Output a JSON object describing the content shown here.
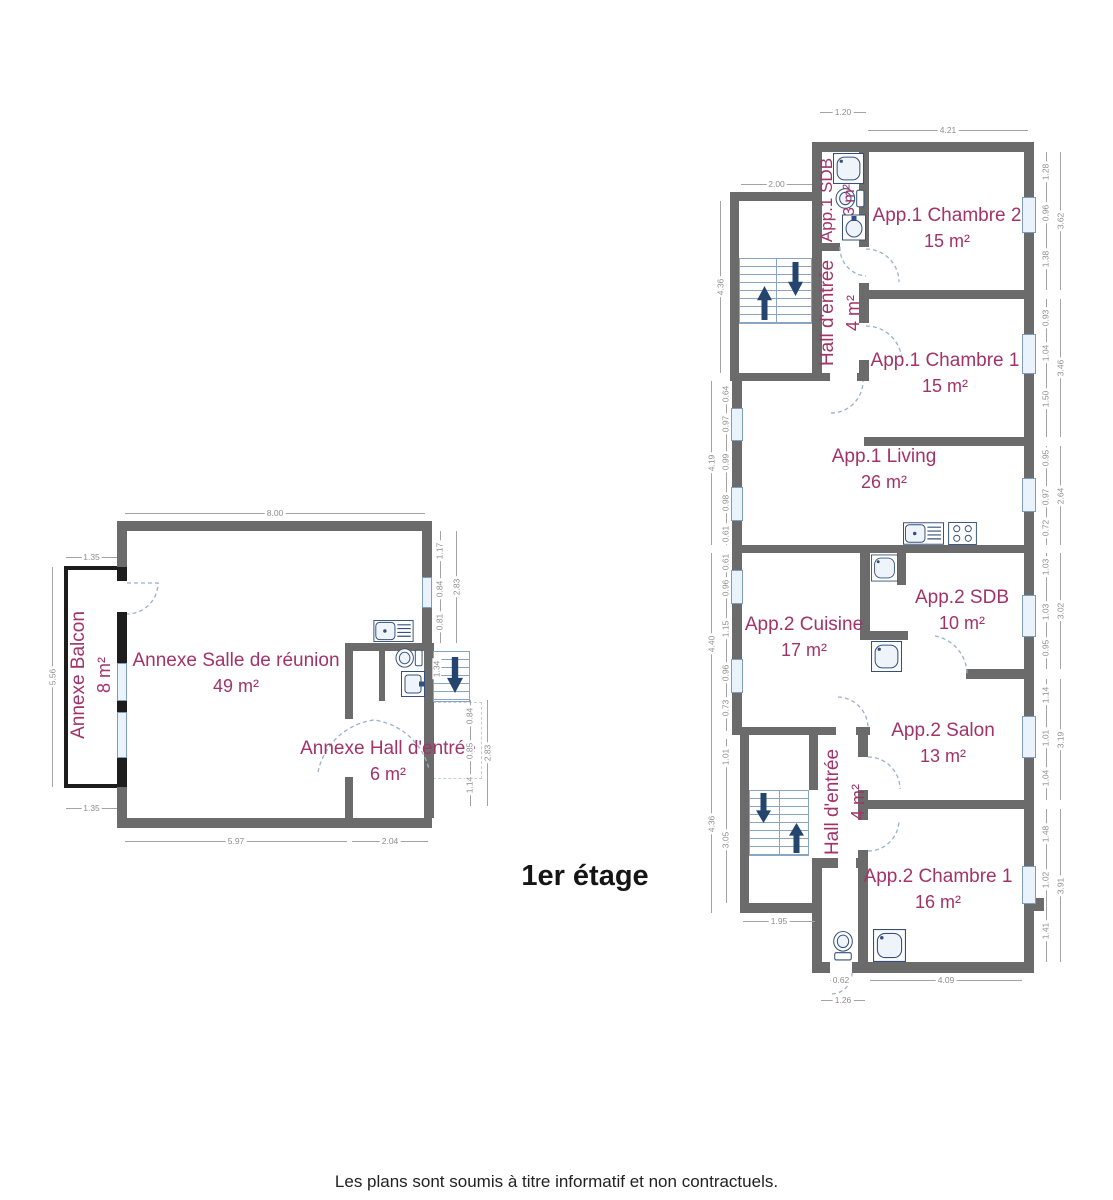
{
  "title": "1er étage",
  "footer": "Les plans sont soumis à titre informatif et non contractuels.",
  "colors": {
    "wall": "#6b6b6b",
    "balcony_wall": "#1d1d1d",
    "room_label": "#a23369",
    "dimension": "#8e8e8e",
    "fixture": "#35507c",
    "arrow": "#24456e",
    "window": "#eaf2fb",
    "door_arc": "#9ab1cc"
  },
  "annexe": {
    "balcon_name": "Annexe Balcon",
    "balcon_area": "8 m²",
    "salle_name": "Annexe Salle de réunion",
    "salle_area": "49 m²",
    "hall_name": "Annexe Hall d'entrée",
    "hall_area": "6 m²",
    "dims": {
      "top": "8.00",
      "balcony_top": "1.35",
      "balcony_left": "5.56",
      "balcony_bottom": "1.35",
      "bottom_salle": "5.97",
      "bottom_hall": "2.04",
      "right_top": [
        "1.17",
        "0.84",
        "0.81"
      ],
      "right_top_total": "2.83",
      "stair": "1.34",
      "right_bottom": [
        "0.84",
        "0.85",
        "1.14"
      ],
      "right_bottom_total": "2.83"
    }
  },
  "main": {
    "sdb1_name": "App.1 SDB",
    "sdb1_area": "3 m²",
    "ch2_name": "App.1 Chambre 2",
    "ch2_area": "15 m²",
    "hall1_name": "Hall d'entrée",
    "hall1_area": "4 m²",
    "ch1_name": "App.1 Chambre 1",
    "ch1_area": "15 m²",
    "living_name": "App.1 Living",
    "living_area": "26 m²",
    "cuisine_name": "App.2 Cuisine",
    "cuisine_area": "17 m²",
    "sdb2_name": "App.2 SDB",
    "sdb2_area": "10 m²",
    "salon_name": "App.2 Salon",
    "salon_area": "13 m²",
    "hall2_name": "Hall d'entrée",
    "hall2_area": "4 m²",
    "ch1b_name": "App.2 Chambre 1",
    "ch1b_area": "16 m²",
    "dims": {
      "top_sdb": "1.20",
      "top_ch2": "4.21",
      "top_stair": "2.00",
      "stair1_left": "4.36",
      "living_left": [
        "0.64",
        "0.97",
        "0.99",
        "0.98",
        "0.61"
      ],
      "living_left_total": "4.19",
      "cuisine_left": [
        "0.61",
        "0.96",
        "1.15",
        "0.96",
        "0.73"
      ],
      "cuisine_left_total": "4.40",
      "stair2_left": [
        "1.01",
        "3.05"
      ],
      "stair2_left_total": "4.36",
      "stair2_bottom": "1.95",
      "bottom_door": "0.62",
      "bottom_door_outer": "1.26",
      "bottom_ch1b": "4.09",
      "ch2_right": [
        "1.28",
        "0.96",
        "1.38"
      ],
      "ch2_right_total": "3.62",
      "ch1_right": [
        "0.93",
        "1.04",
        "1.50"
      ],
      "ch1_right_total": "3.46",
      "living_right": [
        "0.95",
        "0.97",
        "0.72"
      ],
      "living_right_total": "2.64",
      "sdb2_right": [
        "1.03",
        "1.03",
        "0.95"
      ],
      "sdb2_right_total": "3.02",
      "salon_right": [
        "1.14",
        "1.01",
        "1.04"
      ],
      "salon_right_total": "3.19",
      "ch1b_right": [
        "1.48",
        "1.02",
        "1.41"
      ],
      "ch1b_right_total": "3.91"
    }
  }
}
